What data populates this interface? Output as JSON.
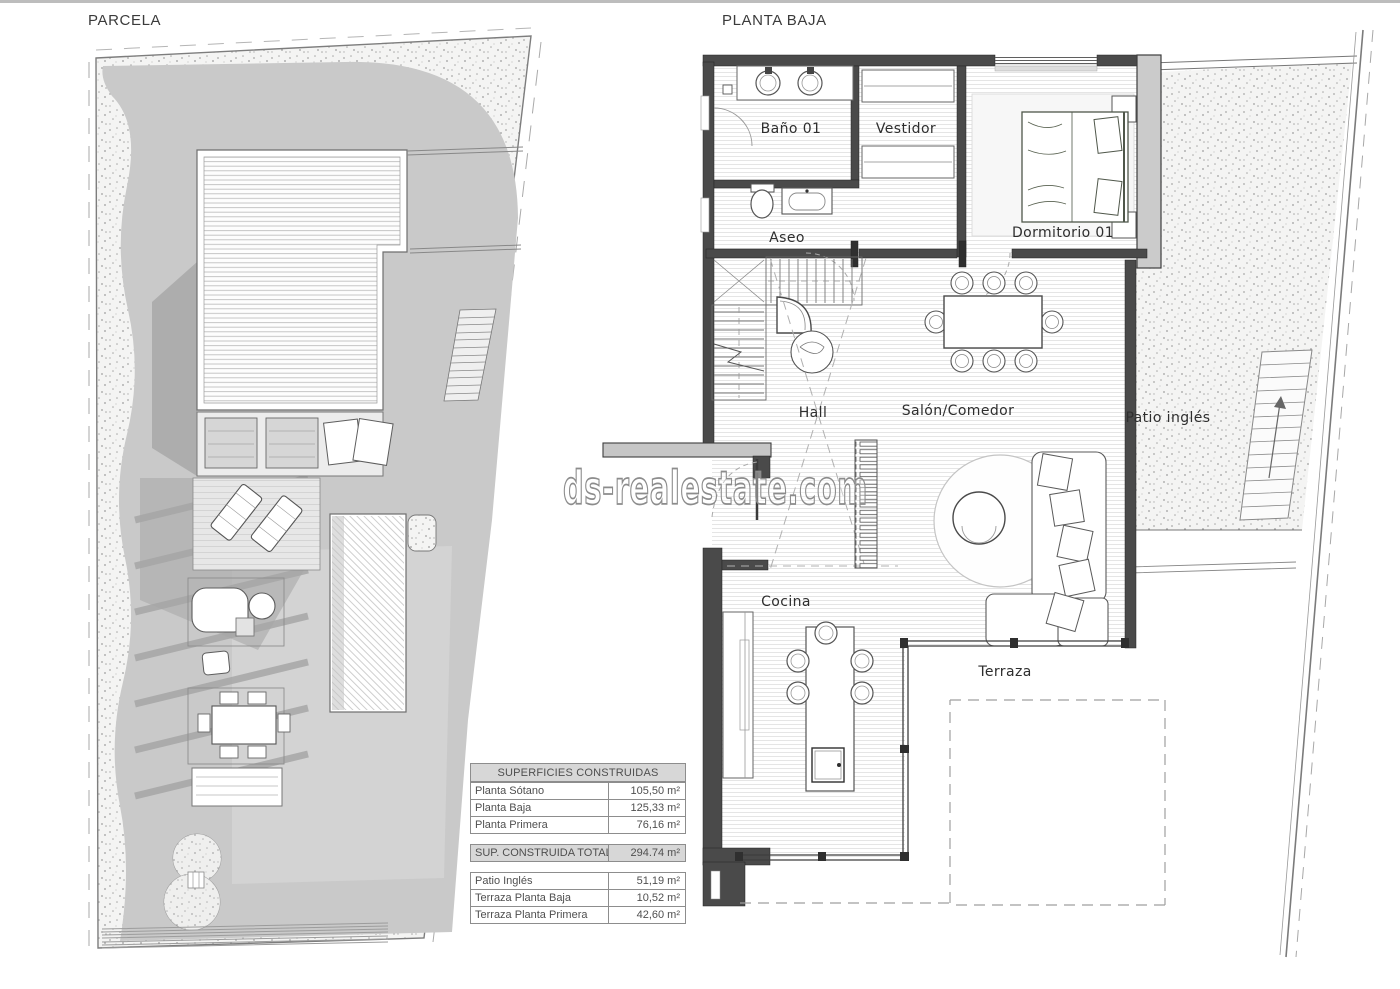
{
  "titles": {
    "parcela": "PARCELA",
    "planta_baja": "PLANTA BAJA"
  },
  "watermark": {
    "text": "ds-realestate.com"
  },
  "rooms": {
    "bano": "Baño 01",
    "vestidor": "Vestidor",
    "aseo": "Aseo",
    "dormitorio": "Dormitorio 01",
    "hall": "Hall",
    "salon": "Salón/Comedor",
    "patio": "Patio inglés",
    "cocina": "Cocina",
    "terraza": "Terraza"
  },
  "areas_table": {
    "header": "SUPERFICIES CONSTRUIDAS",
    "built_rows": [
      {
        "label": "Planta Sótano",
        "value": "105,50 m²"
      },
      {
        "label": "Planta Baja",
        "value": "125,33 m²"
      },
      {
        "label": "Planta Primera",
        "value": "76,16 m²"
      }
    ],
    "total_row": {
      "label": "SUP. CONSTRUIDA TOTAL",
      "value": "294.74 m²"
    },
    "outdoor_rows": [
      {
        "label": "Patio Inglés",
        "value": "51,19 m²"
      },
      {
        "label": "Terraza Planta Baja",
        "value": "10,52 m²"
      },
      {
        "label": "Terraza Planta Primera",
        "value": "42,60 m²"
      }
    ]
  },
  "colors": {
    "wall_dark": "#4a4a4a",
    "wall_light": "#c9c9c9",
    "lawn_gray": "#c9c9c9",
    "table_header_bg": "#d7d7d7",
    "watermark_stroke": "#8c8c8c"
  }
}
